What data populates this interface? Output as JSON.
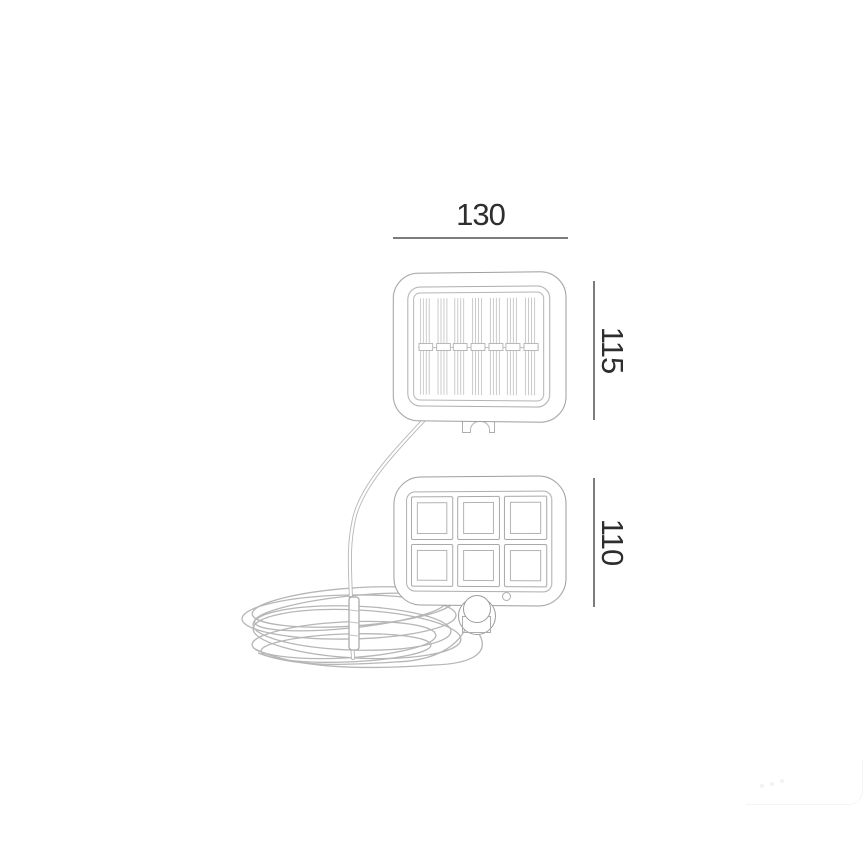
{
  "drawing": {
    "background": "#ffffff",
    "stroke_color": "#9c9c9c",
    "hatch_color": "#cbcbcb",
    "cable_color": "#b6b6b6",
    "dimension_line_color": "#7c7c7c",
    "dimension_text_color": "#2e2e2e",
    "dimensions": {
      "panel_width": {
        "value": "130",
        "orientation": "horizontal",
        "applies_to": "solar-panel-width"
      },
      "panel_height": {
        "value": "115",
        "orientation": "vertical",
        "applies_to": "solar-panel-height"
      },
      "lamp_height": {
        "value": "110",
        "orientation": "vertical",
        "applies_to": "led-lamp-height"
      }
    },
    "parts": {
      "solar_panel": {
        "name": "solar-panel",
        "hatch_clusters": 7
      },
      "panel_mount": {
        "name": "panel-mount-bracket"
      },
      "led_lamp": {
        "name": "led-flood-lamp",
        "segment_rows": 2,
        "segment_columns": 3
      },
      "motion_sensor": {
        "name": "pir-motion-sensor"
      },
      "screw_dot": {
        "name": "indicator-dot"
      },
      "cable": {
        "name": "coiled-power-cable",
        "tie": "cable-tie"
      }
    },
    "watermark": {
      "name": "faint-corner-watermark"
    }
  }
}
